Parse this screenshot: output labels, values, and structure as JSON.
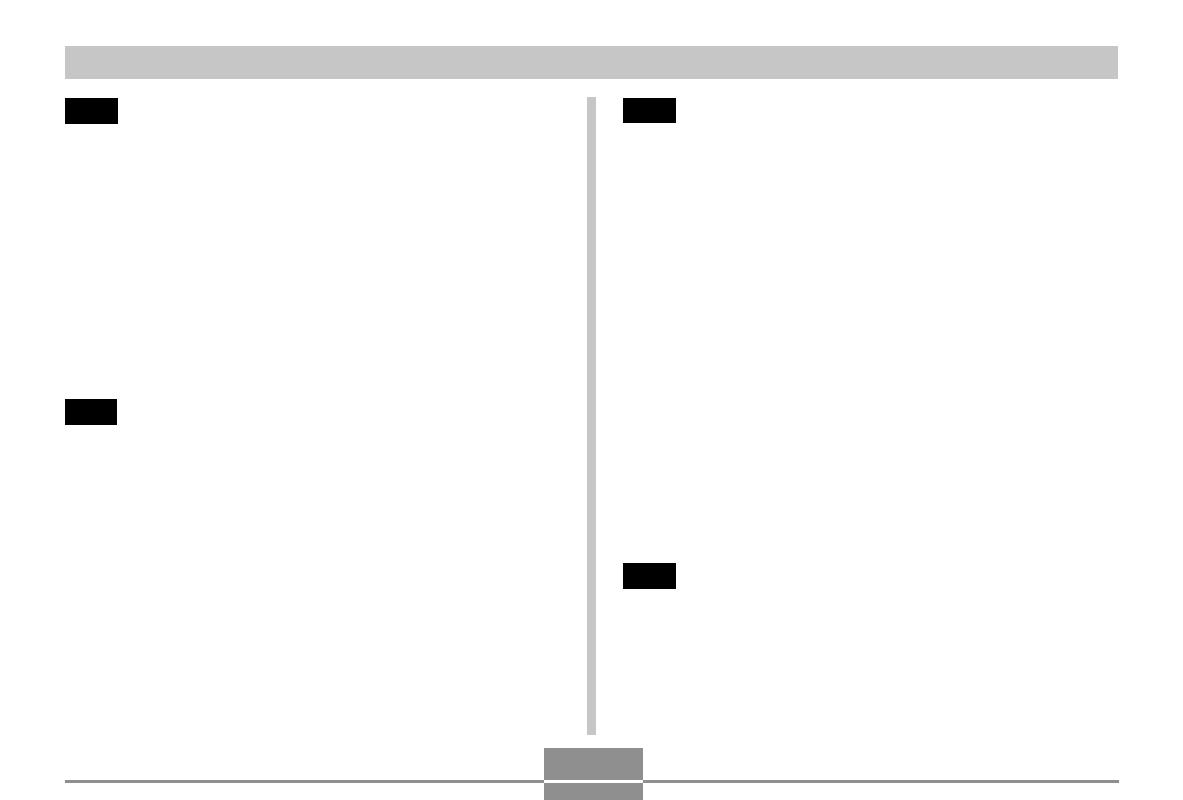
{
  "page": {
    "kind": "scanned-manual-page",
    "background": "#ffffff"
  },
  "colors": {
    "header_bar": "#c6c6c6",
    "column_divider": "#c6c6c6",
    "section_tab": "#000000",
    "footer_rule": "#8f8f8f",
    "page_number_box": "#8f8f8f",
    "footer_box_gap": "#ffffff"
  }
}
